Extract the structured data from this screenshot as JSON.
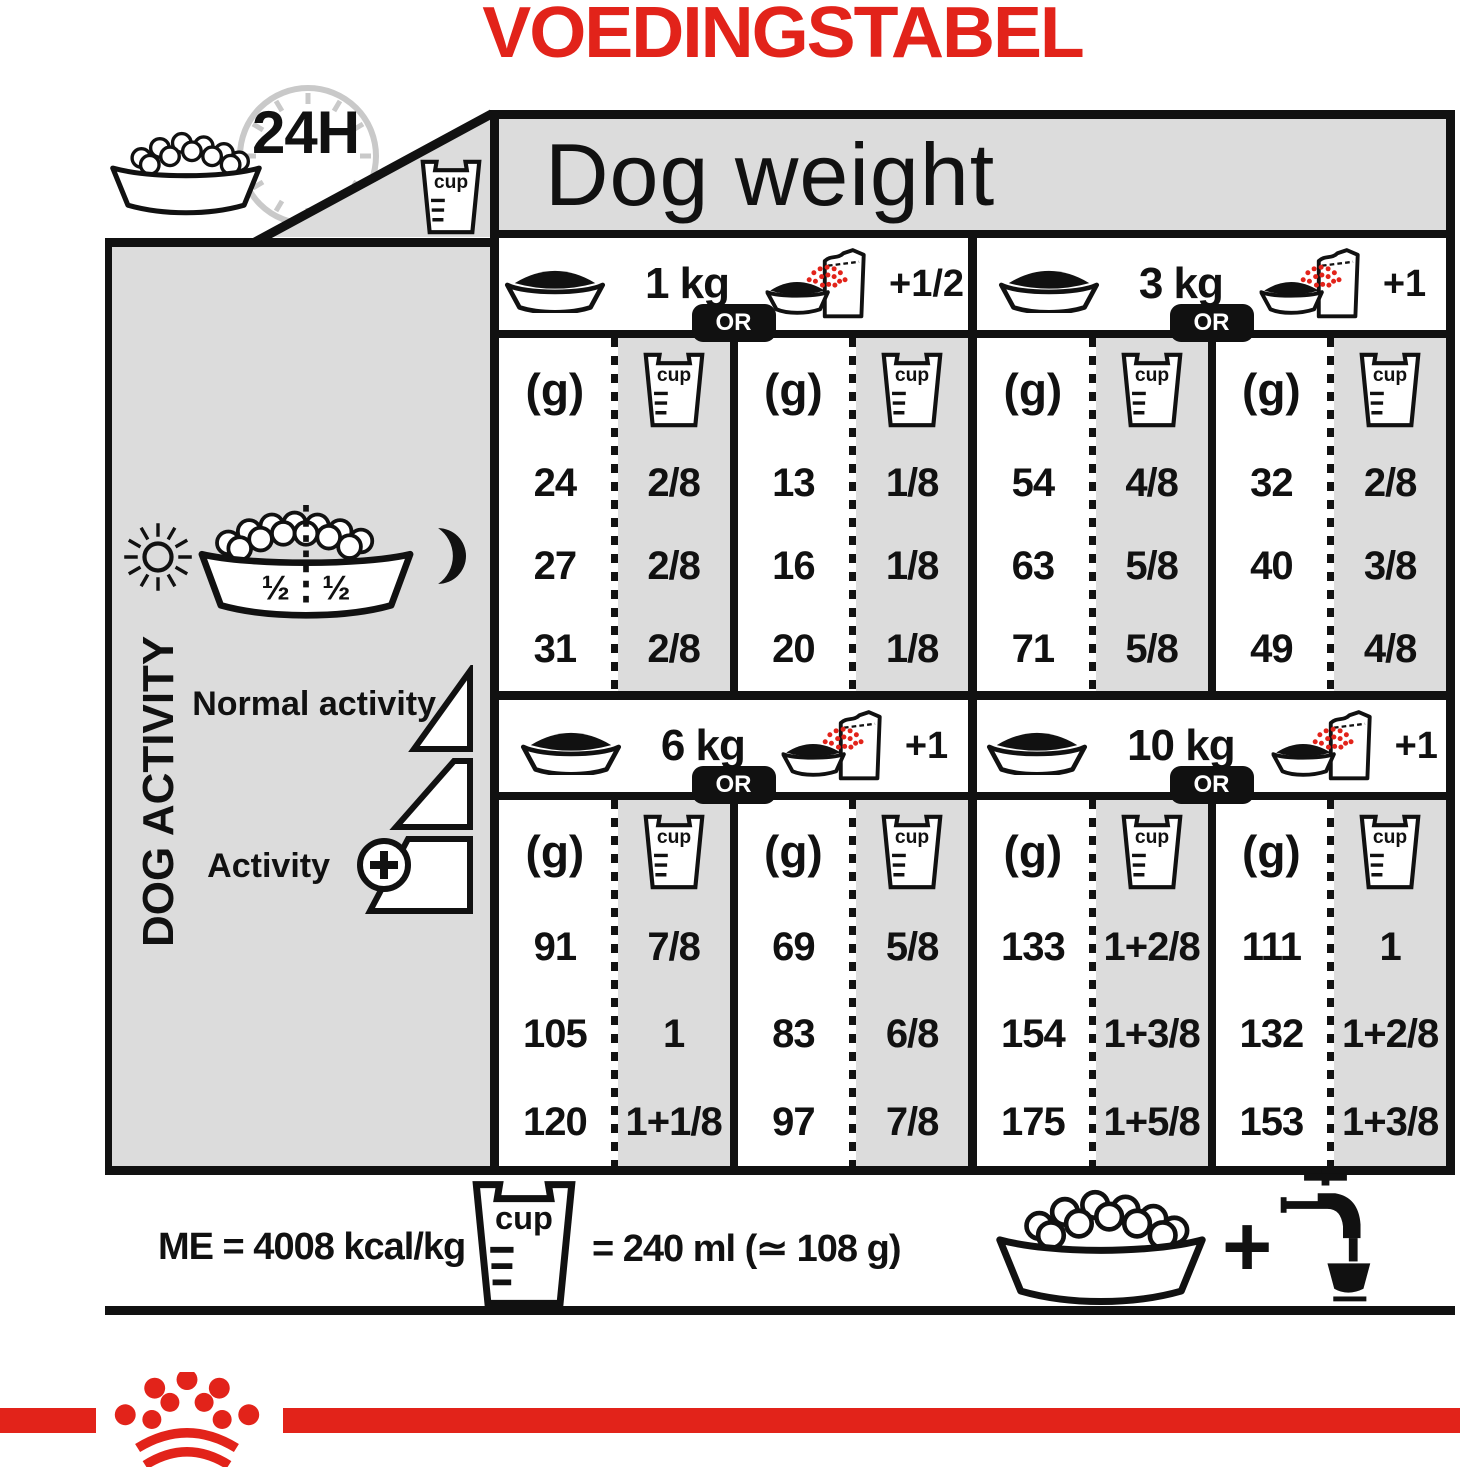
{
  "title": "VOEDINGSTABEL",
  "colors": {
    "red": "#E2231A",
    "panel_gray": "#DCDCDC",
    "ink": "#111111"
  },
  "header": {
    "time_label": "24H",
    "dog_weight_label": "Dog weight"
  },
  "labels": {
    "cup": "cup",
    "or": "OR",
    "grams": "(g)"
  },
  "sidebar": {
    "dog_activity": "DOG ACTIVITY",
    "half_left": "½",
    "half_right": "½",
    "normal_activity": "Normal activity",
    "activity": "Activity"
  },
  "table": {
    "quadrants": [
      {
        "weight": "1 kg",
        "extra": "+1/2",
        "dry_g": [
          "24",
          "27",
          "31"
        ],
        "dry_cup": [
          "2/8",
          "2/8",
          "2/8"
        ],
        "mix_g": [
          "13",
          "16",
          "20"
        ],
        "mix_cup": [
          "1/8",
          "1/8",
          "1/8"
        ]
      },
      {
        "weight": "3 kg",
        "extra": "+1",
        "dry_g": [
          "54",
          "63",
          "71"
        ],
        "dry_cup": [
          "4/8",
          "5/8",
          "5/8"
        ],
        "mix_g": [
          "32",
          "40",
          "49"
        ],
        "mix_cup": [
          "2/8",
          "3/8",
          "4/8"
        ]
      },
      {
        "weight": "6 kg",
        "extra": "+1",
        "dry_g": [
          "91",
          "105",
          "120"
        ],
        "dry_cup": [
          "7/8",
          "1",
          "1+1/8"
        ],
        "mix_g": [
          "69",
          "83",
          "97"
        ],
        "mix_cup": [
          "5/8",
          "6/8",
          "7/8"
        ]
      },
      {
        "weight": "10 kg",
        "extra": "+1",
        "dry_g": [
          "133",
          "154",
          "175"
        ],
        "dry_cup": [
          "1+2/8",
          "1+3/8",
          "1+5/8"
        ],
        "mix_g": [
          "111",
          "132",
          "153"
        ],
        "mix_cup": [
          "1",
          "1+2/8",
          "1+3/8"
        ]
      }
    ]
  },
  "footer": {
    "me_label": "ME = 4008 kcal/kg",
    "cup_equiv": "= 240 ml (≃ 108 g)",
    "plus": "+"
  },
  "chart_data": {
    "type": "table",
    "title": "VOEDINGSTABEL",
    "header": "Dog weight",
    "period": "24H",
    "daily_split": {
      "day": "½",
      "night": "½"
    },
    "activity_levels": [
      "Normal activity",
      "Activity +"
    ],
    "columns_per_weight": [
      "dry only (g)",
      "dry only (cup)",
      "dry + wet (g)",
      "dry + wet (cup)"
    ],
    "weights": [
      {
        "dog_weight": "1 kg",
        "wet_added": "+1/2",
        "rows": [
          {
            "g": 24,
            "cup": "2/8",
            "mix_g": 13,
            "mix_cup": "1/8"
          },
          {
            "g": 27,
            "cup": "2/8",
            "mix_g": 16,
            "mix_cup": "1/8"
          },
          {
            "g": 31,
            "cup": "2/8",
            "mix_g": 20,
            "mix_cup": "1/8"
          }
        ]
      },
      {
        "dog_weight": "3 kg",
        "wet_added": "+1",
        "rows": [
          {
            "g": 54,
            "cup": "4/8",
            "mix_g": 32,
            "mix_cup": "2/8"
          },
          {
            "g": 63,
            "cup": "5/8",
            "mix_g": 40,
            "mix_cup": "3/8"
          },
          {
            "g": 71,
            "cup": "5/8",
            "mix_g": 49,
            "mix_cup": "4/8"
          }
        ]
      },
      {
        "dog_weight": "6 kg",
        "wet_added": "+1",
        "rows": [
          {
            "g": 91,
            "cup": "7/8",
            "mix_g": 69,
            "mix_cup": "5/8"
          },
          {
            "g": 105,
            "cup": "1",
            "mix_g": 83,
            "mix_cup": "6/8"
          },
          {
            "g": 120,
            "cup": "1+1/8",
            "mix_g": 97,
            "mix_cup": "7/8"
          }
        ]
      },
      {
        "dog_weight": "10 kg",
        "wet_added": "+1",
        "rows": [
          {
            "g": 133,
            "cup": "1+2/8",
            "mix_g": 111,
            "mix_cup": "1"
          },
          {
            "g": 154,
            "cup": "1+3/8",
            "mix_g": 132,
            "mix_cup": "1+2/8"
          },
          {
            "g": 175,
            "cup": "1+5/8",
            "mix_g": 153,
            "mix_cup": "1+3/8"
          }
        ]
      }
    ],
    "me": "ME = 4008 kcal/kg",
    "cup_definition": "cup = 240 ml (≃ 108 g)"
  }
}
